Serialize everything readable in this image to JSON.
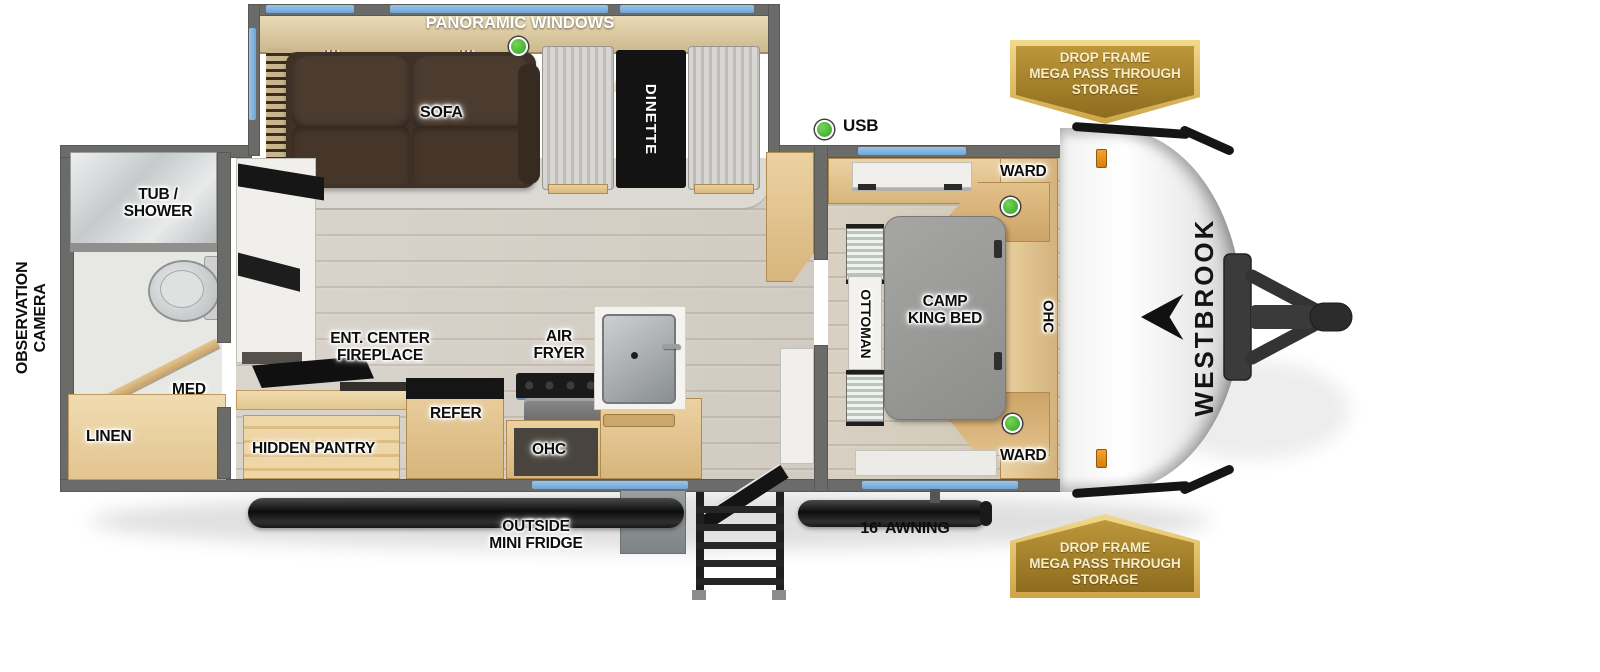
{
  "brand": {
    "name": "WESTBROOK"
  },
  "badge": {
    "line1": "DROP FRAME",
    "line2": "MEGA PASS THROUGH",
    "line3": "STORAGE"
  },
  "slideout": {
    "panoramic_windows": "PANORAMIC WINDOWS",
    "sofa": "SOFA",
    "dinette": "DINETTE"
  },
  "living": {
    "usb": "USB",
    "ent_center_1": "ENT. CENTER",
    "ent_center_2": "FIREPLACE",
    "hidden_pantry": "HIDDEN PANTRY",
    "refer": "REFER",
    "air_fryer_1": "AIR",
    "air_fryer_2": "FRYER",
    "ohc": "OHC"
  },
  "bedroom": {
    "ward_top": "WARD",
    "ward_bottom": "WARD",
    "bed_1": "CAMP",
    "bed_2": "KING BED",
    "ottoman": "OTTOMAN",
    "ohc": "OHC"
  },
  "bathroom": {
    "tub_shower_1": "TUB /",
    "tub_shower_2": "SHOWER",
    "med": "MED",
    "linen": "LINEN"
  },
  "exterior": {
    "observation_1": "OBSERVATION",
    "observation_2": "CAMERA",
    "outside_fridge_1": "OUTSIDE",
    "outside_fridge_2": "MINI FRIDGE",
    "awning": "16' AWNING"
  },
  "colors": {
    "wall_gray": "#6b6b69",
    "accent_blue": "#6ea6d6",
    "badge_gold": "#b9912f",
    "green_indicator": "#3fae3f",
    "wood_tan": "#e0c493",
    "sofa_brown": "#45362b"
  }
}
